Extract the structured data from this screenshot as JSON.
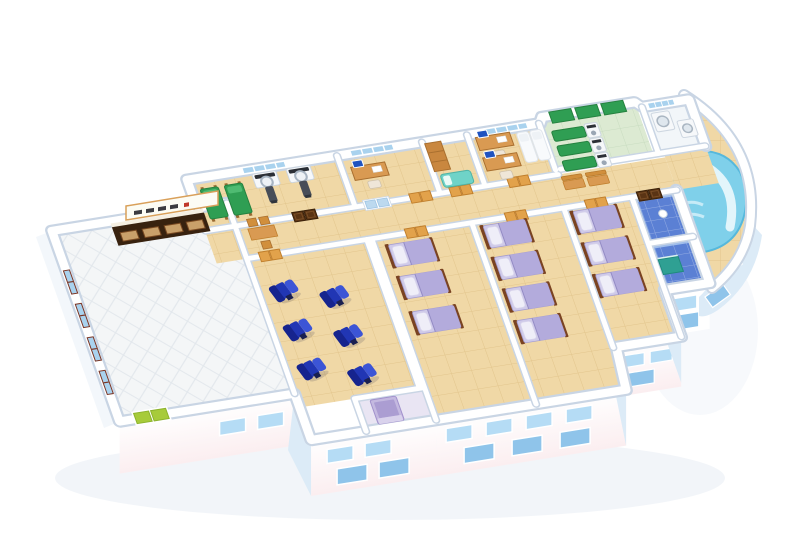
{
  "meta": {
    "title": "3D cutaway floor plan of a clinic ward level",
    "alt": "Isometric 3D cutaway rendering of a single-storey medical facility: entrance hall with reception counter and signboard, imaging room with two scanner machines and green exam beds, offices with desks and computers, physiotherapy room with green treatment tables, utility washroom, curved hydrotherapy pool, infusion room with six blue recliner chairs, three patient wards with purple-bedded beds, blue tiled bathrooms and a corridor with wooden benches."
  },
  "palette": {
    "wallShade": "#c9d5e4",
    "wallLight": "#f3f7fb",
    "floorTan": "#f0d8a6",
    "floorTanLine": "#e2c58c",
    "hallFloor": "#f4f6f7",
    "hallLine": "#e2e7ec",
    "physioFloor": "#dcead2",
    "physioLine": "#c8dcc0",
    "glass": "#a9d2ee",
    "glassDoor": "#bcd9ef",
    "frameDark": "#7a3424",
    "facadePink": "#fbeef0",
    "facadeBlue": "#dcebf7",
    "windowFacade": "#b5dcf5",
    "windowFacadeDark": "#8fc4ea",
    "shadow": "#e9eef5",
    "wood": "#d99a52",
    "woodDark": "#a96f2f",
    "counter": "#38220f",
    "counterPanel": "#c9a06a",
    "signWhite": "#fcfcf4",
    "bedPurple": "#b3abdc",
    "bedPurpleLight": "#cfcae9",
    "pillow": "#efeef8",
    "bedFrame": "#7a4322",
    "recliner": "#2136b4",
    "reclinerDark": "#16248e",
    "reclinerLight": "#3c55d6",
    "green": "#2f9e53",
    "greenDark": "#25813f",
    "greenLight": "#4fbb72",
    "turquoise": "#6fd3c8",
    "machine": "#f6f8fa",
    "machineShade": "#cdd6e0",
    "screenDark": "#2b2f36",
    "screenBlue": "#1f53c0",
    "poolWater": "#7fd0ea",
    "poolWaterDeep": "#56b8dc",
    "poolBench": "#e2f5fb",
    "blueTileFloor": "#5b80d4",
    "blueWall": "#a9c4ec",
    "teal": "#2fa093",
    "doorOrange": "#e2a24b",
    "doorOrangeDark": "#c07f2d",
    "doorGreen": "#a7cb3a",
    "doorGreenDark": "#8cb32c"
  },
  "scene": {
    "building": "single-storey clinic wing, isometric cutaway view on white background",
    "rooms": [
      {
        "name": "entrance-hall",
        "contents": "reception counter with four service windows, signboard above, window wall with dark red frames, green double entrance door"
      },
      {
        "name": "imaging-room",
        "contents": "two white scanner machines with dark patient tables, two green exam beds, window"
      },
      {
        "name": "doctor-office",
        "contents": "wooden desk with computer, window, glass double door"
      },
      {
        "name": "store-room",
        "contents": "tall wooden cabinet, turquoise cot"
      },
      {
        "name": "consulting-room",
        "contents": "two desks with computers, two white couches, low table"
      },
      {
        "name": "physiotherapy-room",
        "contents": "three green treatment tables with white therapy machines, green wall panels"
      },
      {
        "name": "utility-washroom",
        "contents": "two white machines with round doors"
      },
      {
        "name": "hydrotherapy-pool-room",
        "contents": "curved blue pool with bench and steps on tiled deck"
      },
      {
        "name": "infusion-room",
        "contents": "six royal-blue recliner chairs in two rows"
      },
      {
        "name": "ward-1",
        "contents": "three beds with purple bedding and wooden frames"
      },
      {
        "name": "shower-room",
        "contents": "purple shower stall"
      },
      {
        "name": "ward-2",
        "contents": "four beds with purple bedding and wooden frames"
      },
      {
        "name": "ward-3",
        "contents": "three beds with purple bedding and wooden frames"
      },
      {
        "name": "bath-rooms",
        "contents": "blue tiled cells with teal cabinet and dark wood doors"
      },
      {
        "name": "corridor",
        "contents": "wooden table with chairs, two wooden benches, orange and dark-brown doors"
      }
    ]
  }
}
